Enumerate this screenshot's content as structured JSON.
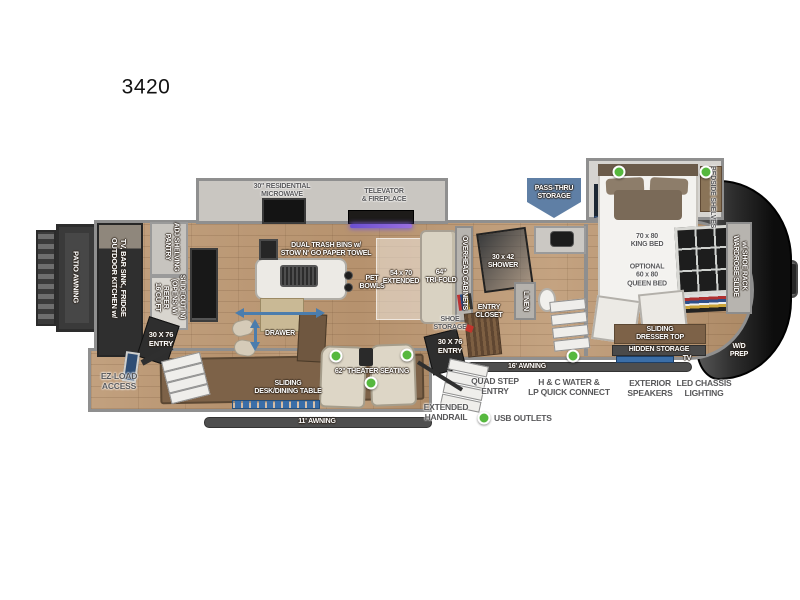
{
  "title": "3420",
  "colors": {
    "usb_green": "#56b83e",
    "banner_blue": "#5f7fa5",
    "arrow_blue": "#4b7dad",
    "tv_blue": "#3a6ea8",
    "wood_floor": "#bd9c7d",
    "cap_dark": "#1a1a1a",
    "furniture_brown": "#7d6248",
    "label_dark": "#58585a",
    "shoe_red": "#c2342c"
  },
  "exterior": {
    "patio_awning": "PATIO AWNING",
    "outdoor_kitchen": "OUTDOOR KITCHEN w/\nTV, BAR SINK, FRIDGE",
    "ez_load": "EZ-LOAD\nACCESS",
    "awning_11": "11' AWNING",
    "awning_16": "16' AWNING",
    "pass_thru": "PASS-THRU\nSTORAGE",
    "quad_step": "QUAD STEP\nENTRY",
    "water_connect": "H & C WATER &\nLP QUICK CONNECT",
    "exterior_speakers": "EXTERIOR\nSPEAKERS",
    "led_chassis": "LED CHASSIS\nLIGHTING",
    "extended_handrail": "EXTENDED\nHANDRAIL",
    "entry_left": "30 X 76\nENTRY",
    "entry_mid": "30 X 76\nENTRY",
    "usb_legend": "USB OUTLETS"
  },
  "kitchen": {
    "microwave": "30\" RESIDENTIAL\nMICROWAVE",
    "televator": "TELEVATOR\n& FIREPLACE",
    "trash_bins": "DUAL TRASH BINS w/\nSTOW N' GO PAPER TOWEL",
    "pet_bowls": "PET\nBOWLS",
    "pantry": "PANTRY\nADJ SHELVING",
    "refer": "16 CU FT\nREFER\n(OPENS W/\nSLIDEOUT IN)",
    "drawer": "DRAWER"
  },
  "living": {
    "tri_fold": "64\"\nTRI-FOLD",
    "extended": "54 x 70\nEXTENDED",
    "overhead_cabinets": "OVERHEAD CABINETS",
    "theater": "62\" THEATER SEATING",
    "desk": "SLIDING\nDESK/DINING TABLE"
  },
  "bath": {
    "shower": "30 x 42\nSHOWER",
    "linen": "LINEN",
    "entry_closet": "ENTRY\nCLOSET",
    "shoe_storage": "SHOE\nSTORAGE"
  },
  "bedroom": {
    "king_bed": "70 x 80\nKING BED",
    "queen_bed": "OPTIONAL\n60 x 80\nQUEEN BED",
    "bedside_shelves": "BEDSIDE SHELVES",
    "wardrobe": "WARDROBE SLIDE\nw/ SHOE RACK",
    "dresser_top": "SLIDING\nDRESSER TOP",
    "hidden_storage": "HIDDEN STORAGE",
    "tv": "TV",
    "wd_prep": "W/D\nPREP"
  }
}
